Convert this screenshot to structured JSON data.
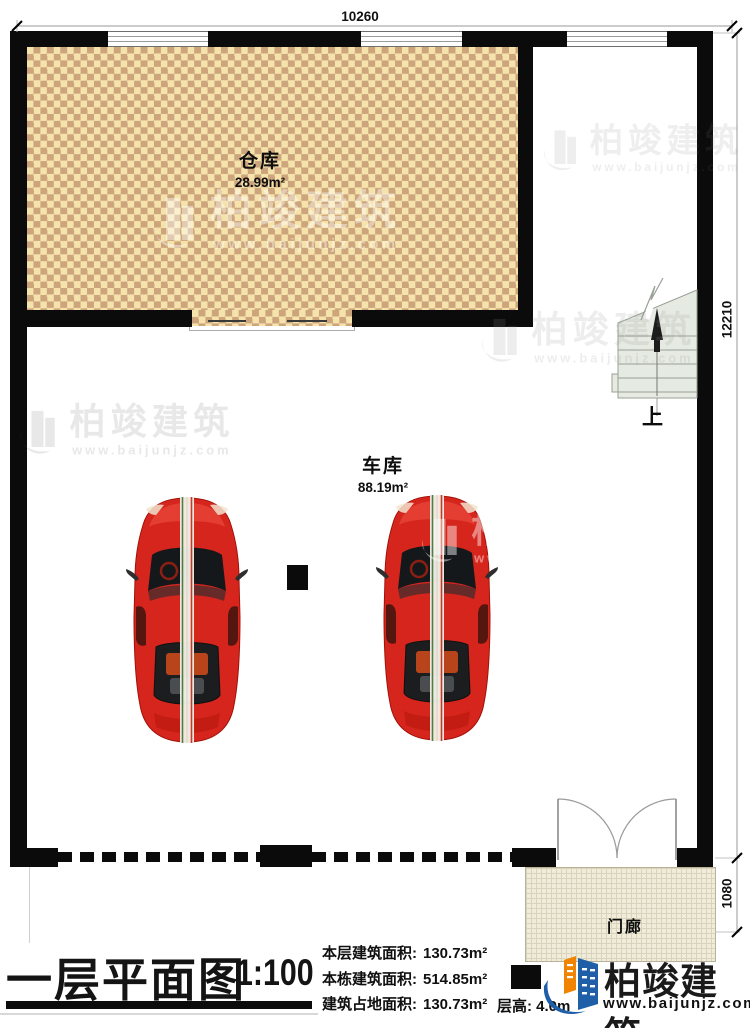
{
  "plan": {
    "rooms": [
      {
        "name": "仓库",
        "area": "28.99m²"
      },
      {
        "name": "车库",
        "area": "88.19m²"
      },
      {
        "name": "门廊",
        "area": ""
      }
    ],
    "stairs_up_label": "上",
    "dimensions": {
      "top": "10260",
      "right": "12210",
      "porch_right": "1080"
    }
  },
  "watermark": {
    "brand": "柏竣建筑",
    "url": "www.baijunjz.com"
  },
  "title_block": {
    "title": "一层平面图",
    "scale": "1:100",
    "stats": [
      {
        "label": "本层建筑面积:",
        "value": "130.73m²"
      },
      {
        "label": "本栋建筑面积:",
        "value": "514.85m²"
      },
      {
        "label": "建筑占地面积:",
        "value": "130.73m²"
      }
    ],
    "floor_height": "层高: 4.0m",
    "logo": {
      "brand": "柏竣建筑",
      "url": "www.baijunjz.com"
    }
  },
  "colors": {
    "wall": "#0b0b0b",
    "checker_light": "#f6e3ac",
    "checker_dark": "#cda57d",
    "porch_bg": "#f0ecd9",
    "porch_grid": "#d8d3bb",
    "stair_fill": "#e5eae2",
    "stair_line": "#9aa096",
    "car_red": "#d6251d",
    "logo_blue": "#1e5fa8",
    "logo_orange": "#f08300"
  }
}
